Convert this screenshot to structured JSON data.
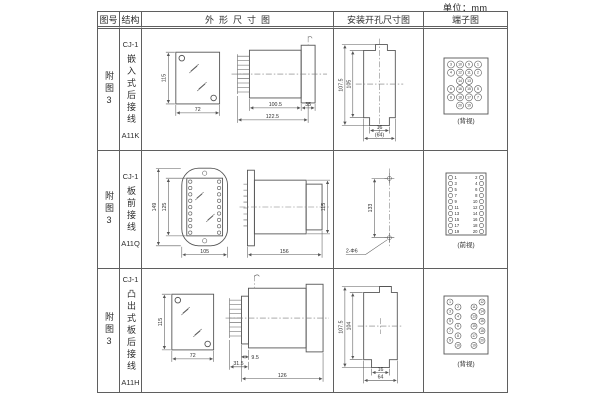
{
  "page": {
    "unit": "单位：mm"
  },
  "table": {
    "headers": [
      "图号",
      "结构",
      "外形尺寸图",
      "安装开孔尺寸图",
      "端子图"
    ]
  },
  "rows": [
    {
      "fig": "附图3",
      "series": "CJ-1",
      "mount": "嵌入式后接线",
      "code": "A11K",
      "outline": {
        "front_h": "115",
        "front_w": "72",
        "side_d1": "100.5",
        "side_d2": "122.5",
        "side_d3": "35"
      },
      "install": {
        "v1": "107.5",
        "v2": "105",
        "h1": "16",
        "h2": "(64)"
      },
      "terminal": {
        "view": "(背视)",
        "grid": [
          [
            3,
            10,
            9,
            1
          ],
          [
            4,
            12,
            11,
            2
          ],
          [
            null,
            14,
            13,
            null
          ],
          [
            6,
            16,
            15,
            5
          ],
          [
            8,
            18,
            17,
            7
          ],
          [
            null,
            20,
            19,
            null
          ]
        ]
      }
    },
    {
      "fig": "附图3",
      "series": "CJ-1",
      "mount": "板前接线",
      "code": "A11Q",
      "outline": {
        "front_h1": "149",
        "front_h2": "125",
        "front_w": "105",
        "side_len": "156",
        "side_h": "115"
      },
      "install": {
        "v": "133",
        "note": "2-Φ6"
      },
      "terminal": {
        "view": "(前视)",
        "left": [
          1,
          3,
          5,
          7,
          9,
          11,
          13,
          15,
          17,
          19
        ],
        "right": [
          2,
          4,
          6,
          8,
          10,
          12,
          14,
          16,
          18,
          20
        ]
      }
    },
    {
      "fig": "附图3",
      "series": "CJ-1",
      "mount": "凸出式板后接线",
      "code": "A11H",
      "outline": {
        "front_h": "115",
        "front_w": "72",
        "side_d1": "31.5",
        "side_d2": "9.5",
        "side_d3": "126"
      },
      "install": {
        "v1": "107.5",
        "v2": "104",
        "h1": "16",
        "h2": "64"
      },
      "terminal": {
        "view": "(背视)",
        "cols": [
          [
            1,
            3,
            5,
            7,
            9
          ],
          [
            2,
            4,
            6,
            8,
            10
          ],
          [
            11,
            13,
            15,
            17,
            19
          ],
          [
            12,
            14,
            16,
            18,
            20
          ]
        ]
      }
    }
  ]
}
